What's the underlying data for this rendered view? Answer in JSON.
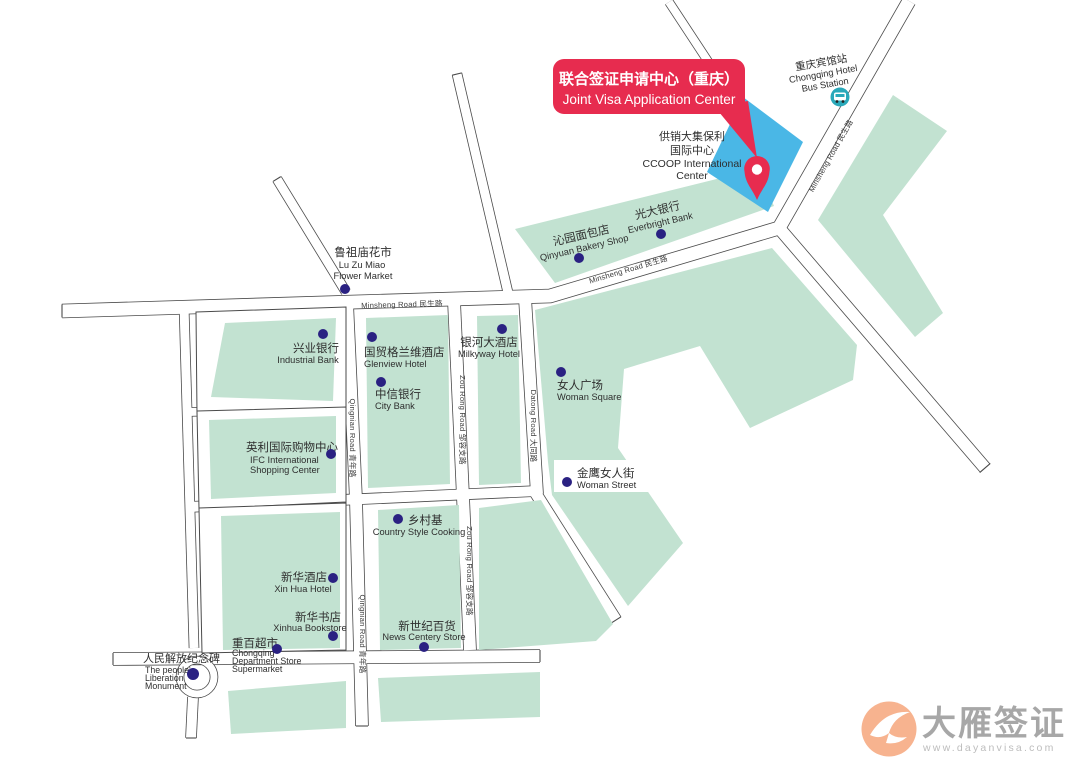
{
  "banner": {
    "zh": "联合签证申请中心（重庆）",
    "en": "Joint Visa Application Center"
  },
  "ccoop": {
    "lines": [
      "供销大集保利",
      "国际中心",
      "CCOOP International",
      "Center"
    ]
  },
  "bus_station": {
    "lines": [
      "重庆宾馆站",
      "Chongqing Hotel",
      "Bus Station"
    ]
  },
  "roads": {
    "minsheng": "Minsheng Road 民生路",
    "qingnian": "Qingnian Road 青年路",
    "zourong": "Zou Rong Road 邹容支路",
    "datong": "Datong Road 大同路"
  },
  "pois": {
    "luzumiao": {
      "lines": [
        "鲁祖庙花市",
        "Lu Zu Miao",
        "Flower Market"
      ]
    },
    "qinyuan": {
      "lines": [
        "沁园面包店",
        "Qinyuan Bakery Shop"
      ]
    },
    "everbright": {
      "lines": [
        "光大银行",
        "Everbright Bank"
      ]
    },
    "industrial": {
      "lines": [
        "兴业银行",
        "Industrial Bank"
      ]
    },
    "glenview": {
      "lines": [
        "国贸格兰维酒店",
        "Glenview Hotel"
      ]
    },
    "milkyway": {
      "lines": [
        "银河大酒店",
        "Milkyway Hotel"
      ]
    },
    "citybank": {
      "lines": [
        "中信银行",
        "City Bank"
      ]
    },
    "womansquare": {
      "lines": [
        "女人广场",
        "Woman Square"
      ]
    },
    "womanstreet": {
      "lines": [
        "金鹰女人街",
        "Woman Street"
      ]
    },
    "ifc": {
      "lines": [
        "英利国际购物中心",
        "IFC International",
        "Shopping Center"
      ]
    },
    "xinhuahotel": {
      "lines": [
        "新华酒店",
        "Xin Hua Hotel"
      ]
    },
    "xinhuabook": {
      "lines": [
        "新华书店",
        "Xinhua Bookstore"
      ]
    },
    "cqstore": {
      "lines": [
        "重百超市",
        "Chongqing",
        "Department Store",
        "Supermarket"
      ]
    },
    "country": {
      "lines": [
        "乡村基",
        "Country Style Cooking"
      ]
    },
    "news": {
      "lines": [
        "新世纪百货",
        "News Centery Store"
      ]
    },
    "monument": {
      "lines": [
        "人民解放纪念碑",
        "The people's",
        "Liberation",
        "Monument"
      ]
    }
  },
  "logo": {
    "name": "大雁签证",
    "url": "www.dayanvisa.com"
  },
  "colors": {
    "block_green": "#c2e2d1",
    "highlight_blue": "#4ab7e6",
    "accent_red": "#e72c4f",
    "marker_navy": "#2a2182",
    "bus_teal": "#2aa9ba",
    "logo_orange": "#f7b38f"
  }
}
